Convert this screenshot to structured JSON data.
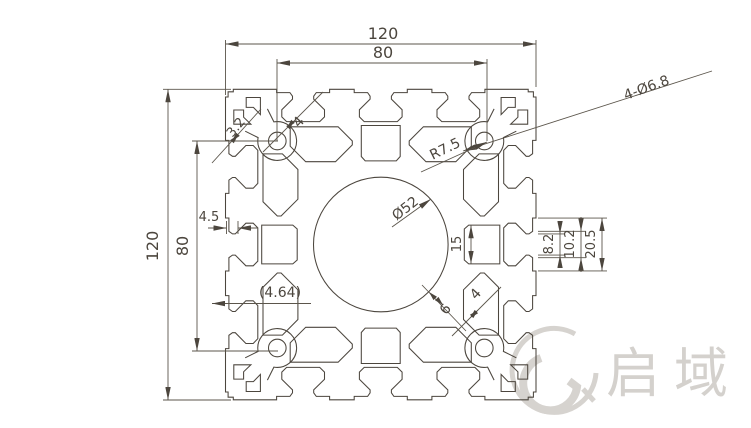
{
  "dims": {
    "overall_width": "120",
    "hole_pitch_top": "80",
    "overall_height": "120",
    "hole_pitch_left": "80",
    "wall_thickness": "3.2",
    "web_top": "4",
    "corner_holes": "4-Ø6.8",
    "corner_radius": "R7.5",
    "center_bore": "Ø52",
    "cavity_height": "15",
    "lip_depth": "4.5",
    "ref_wall": "(4.64)",
    "bore_wall": "6",
    "web_bottom": "4",
    "slot_opening": "8.2",
    "slot_throat": "10.2",
    "slot_mouth": "20.5"
  },
  "watermark": {
    "brand": "启域"
  },
  "colors": {
    "line": "#4c463e",
    "dim": "#5b554b",
    "watermark": "#d4d1cd"
  }
}
